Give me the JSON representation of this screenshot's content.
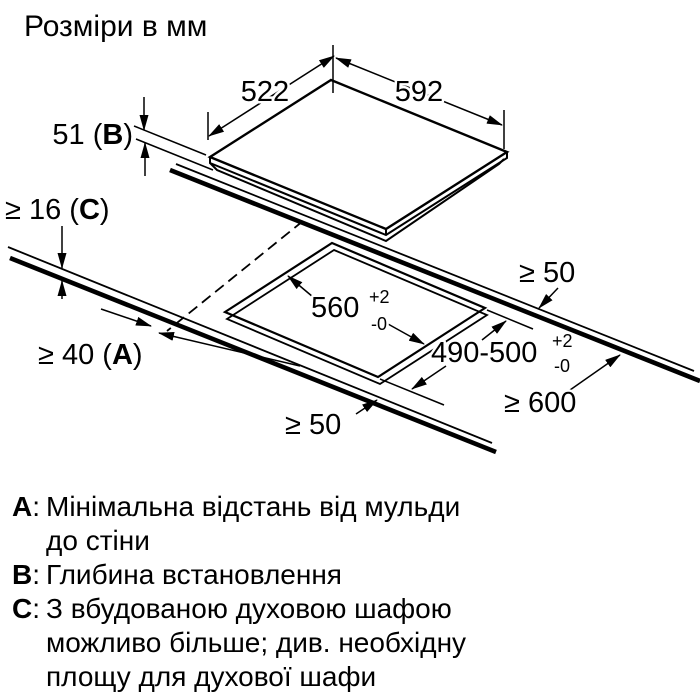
{
  "title": "Розміри в мм",
  "dimensions": {
    "hob_depth": "522",
    "hob_width": "592",
    "hob_height": {
      "pre": "51 (",
      "letter": "B",
      "post": ")"
    },
    "worktop_thickness": {
      "pre": "≥ 16 (",
      "letter": "C",
      "post": ")"
    },
    "wall_distance": {
      "pre": "≥ 40 (",
      "letter": "A",
      "post": ")"
    },
    "cutout_width": {
      "value": "560",
      "tol_plus": "+2",
      "tol_minus": "-0"
    },
    "cutout_depth": {
      "value": "490-500",
      "tol_plus": "+2",
      "tol_minus": "-0"
    },
    "clearance_rear": "≥ 50",
    "clearance_front": "≥ 50",
    "worktop_depth_min": "≥ 600"
  },
  "legend": {
    "colon": ":",
    "items": [
      {
        "letter": "A",
        "lines": [
          "Мінімальна відстань від мульди",
          "до стіни"
        ]
      },
      {
        "letter": "B",
        "lines": [
          "Глибина встановлення"
        ]
      },
      {
        "letter": "C",
        "lines": [
          "З вбудованою духовою шафою",
          "можливо більше; див. необхідну",
          "площу для духової шафи"
        ]
      }
    ]
  }
}
